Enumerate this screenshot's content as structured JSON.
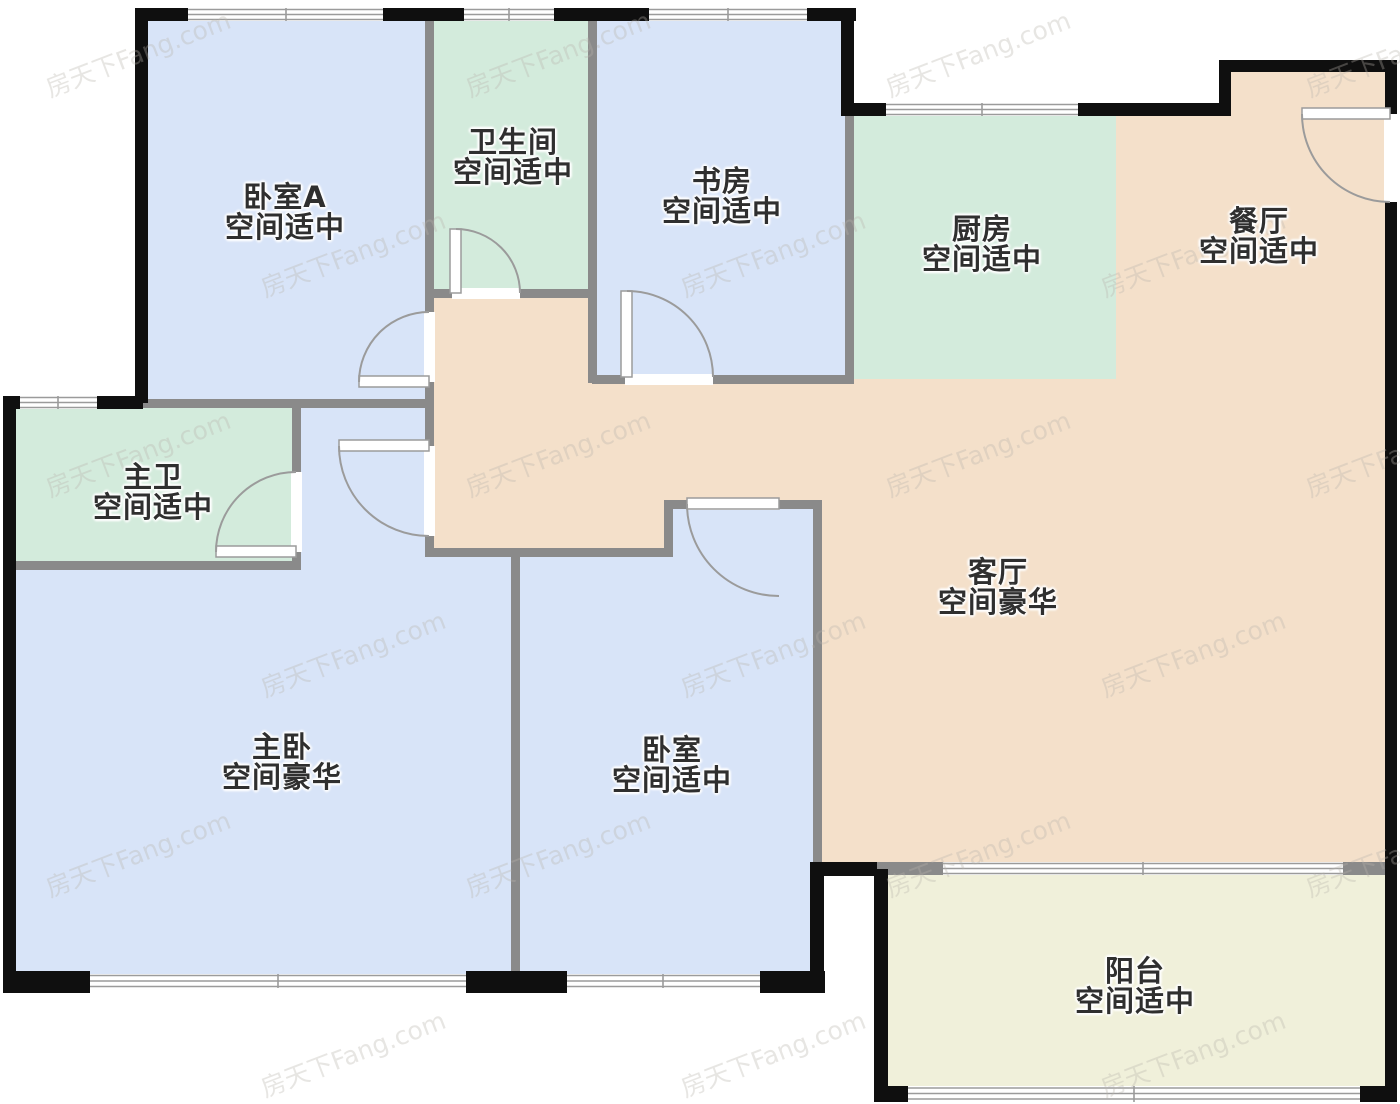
{
  "floorplan": {
    "watermark_text": "房天下Fang.com",
    "colors": {
      "room_blue": "#d8e4f8",
      "room_green": "#d3ebdc",
      "room_peach": "#f4e0ca",
      "room_yellow": "#f0f0da",
      "wall_black": "#0f0f0f",
      "wall_gray": "#8a8a8a",
      "fixture_line": "#9b9b9b",
      "label_text": "#2f2f2f",
      "watermark_gray": "#b9b4ac"
    },
    "rooms": [
      {
        "id": "bedroom-a",
        "name": "卧室A",
        "size": "空间适中"
      },
      {
        "id": "bathroom",
        "name": "卫生间",
        "size": "空间适中"
      },
      {
        "id": "study",
        "name": "书房",
        "size": "空间适中"
      },
      {
        "id": "kitchen",
        "name": "厨房",
        "size": "空间适中"
      },
      {
        "id": "dining",
        "name": "餐厅",
        "size": "空间适中"
      },
      {
        "id": "master-bath",
        "name": "主卫",
        "size": "空间适中"
      },
      {
        "id": "living",
        "name": "客厅",
        "size": "空间豪华"
      },
      {
        "id": "master-bedroom",
        "name": "主卧",
        "size": "空间豪华"
      },
      {
        "id": "bedroom",
        "name": "卧室",
        "size": "空间适中"
      },
      {
        "id": "balcony",
        "name": "阳台",
        "size": "空间适中"
      }
    ]
  }
}
